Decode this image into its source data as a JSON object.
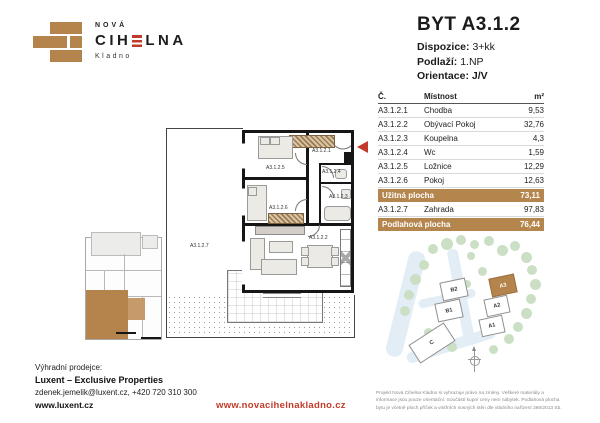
{
  "logo": {
    "line1": "NOVÁ",
    "line2_pre": "CIH",
    "line2_post": "LNA",
    "line3": "Kladno"
  },
  "header": {
    "title": "BYT A3.1.2",
    "specs": [
      {
        "label": "Dispozice:",
        "value": "3+kk"
      },
      {
        "label": "Podlaží:",
        "value": "1.NP"
      },
      {
        "label": "Orientace:",
        "value": "J/V"
      }
    ]
  },
  "room_table": {
    "headers": {
      "code": "Č.",
      "name": "Místnost",
      "area": "m²"
    },
    "rows": [
      {
        "code": "A3.1.2.1",
        "name": "Chodba",
        "area": "9,53"
      },
      {
        "code": "A3.1.2.2",
        "name": "Obývací Pokoj",
        "area": "32,76"
      },
      {
        "code": "A3.1.2.3",
        "name": "Koupelna",
        "area": "4,3"
      },
      {
        "code": "A3.1.2.4",
        "name": "Wc",
        "area": "1,59"
      },
      {
        "code": "A3.1.2.5",
        "name": "Ložnice",
        "area": "12,29"
      },
      {
        "code": "A3.1.2.6",
        "name": "Pokoj",
        "area": "12,63"
      },
      {
        "code": "A3.1.2.7",
        "name": "Zahrada",
        "area": "97,83"
      }
    ],
    "summary": [
      {
        "label": "Užitná plocha",
        "value": "73,11"
      },
      {
        "label": "Podlahová plocha",
        "value": "76,44"
      }
    ]
  },
  "plan": {
    "labels": {
      "chodba": "A3.1.2.1",
      "obyvak": "A3.1.2.2",
      "koupelna": "A3.1.2.3",
      "wc": "A3.1.2.4",
      "loznice": "A3.1.2.5",
      "pokoj": "A3.1.2.6",
      "zahrada": "A3.1.2.7"
    }
  },
  "site_plan": {
    "buildings": [
      {
        "id": "B2"
      },
      {
        "id": "B1"
      },
      {
        "id": "A3"
      },
      {
        "id": "A2"
      },
      {
        "id": "A1"
      },
      {
        "id": "C"
      }
    ]
  },
  "footer": {
    "seller_label": "Výhradní prodejce:",
    "seller_name": "Luxent – Exclusive Properties",
    "seller_contact": "zdenek.jemelik@luxent.cz, +420 720 310 300",
    "seller_url": "www.luxent.cz",
    "project_url": "www.novacihelnakladno.cz",
    "disclaimer": "Projekt Nová Cihelna Kladno si vyhrazuje právo na změny. Veškeré materiály a informace jsou pouze orientační. Součástí kupní ceny není nábytek. Podlahová plocha bytu je včetně ploch příček a vnitřních nosných stěn dle vládního nařízení 366/2013 Sb."
  },
  "colors": {
    "brick": "#b5834c",
    "accent_red": "#c23b2a",
    "wall_black": "#161616",
    "tree_green": "#cbdfc5",
    "road_blue": "#e2edf5"
  }
}
